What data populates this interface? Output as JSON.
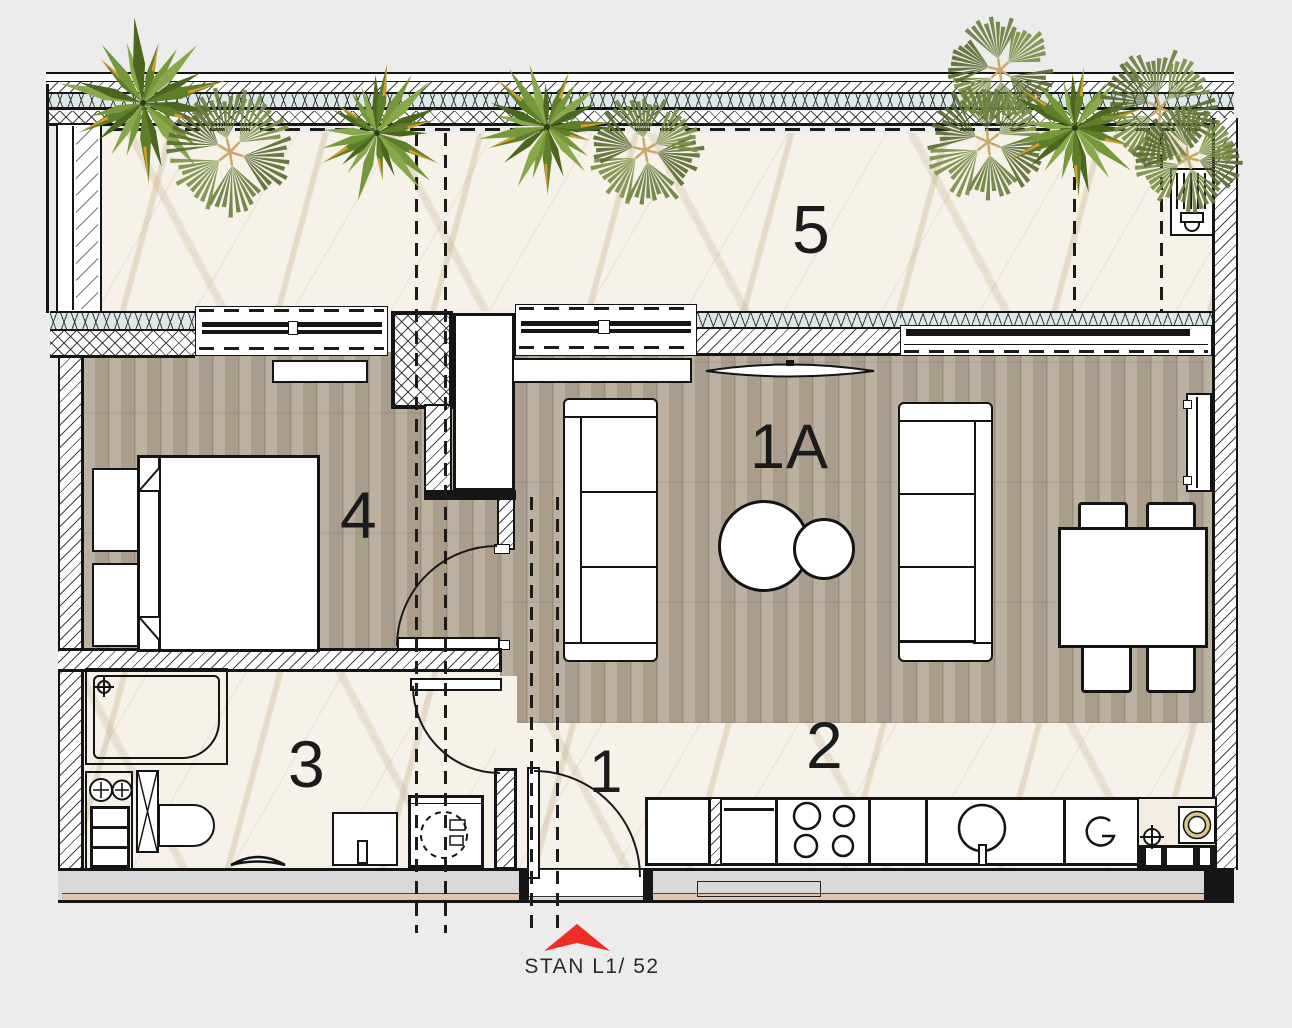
{
  "plan": {
    "title": "STAN L1/ 52",
    "rooms": [
      {
        "label": "5",
        "name": "terrace"
      },
      {
        "label": "4",
        "name": "bedroom"
      },
      {
        "label": "1A",
        "name": "living room"
      },
      {
        "label": "3",
        "name": "bathroom"
      },
      {
        "label": "2",
        "name": "kitchen"
      },
      {
        "label": "1",
        "name": "hallway"
      }
    ],
    "colors": {
      "accent_red": "#ee2d24",
      "wood_floor": "#b4a795",
      "marble_floor": "#f6f2ea",
      "insulation_blue": "#dce9e8",
      "wall_band_gray": "#d9d9d9",
      "stripe_salmon": "#e7c3b2"
    }
  }
}
